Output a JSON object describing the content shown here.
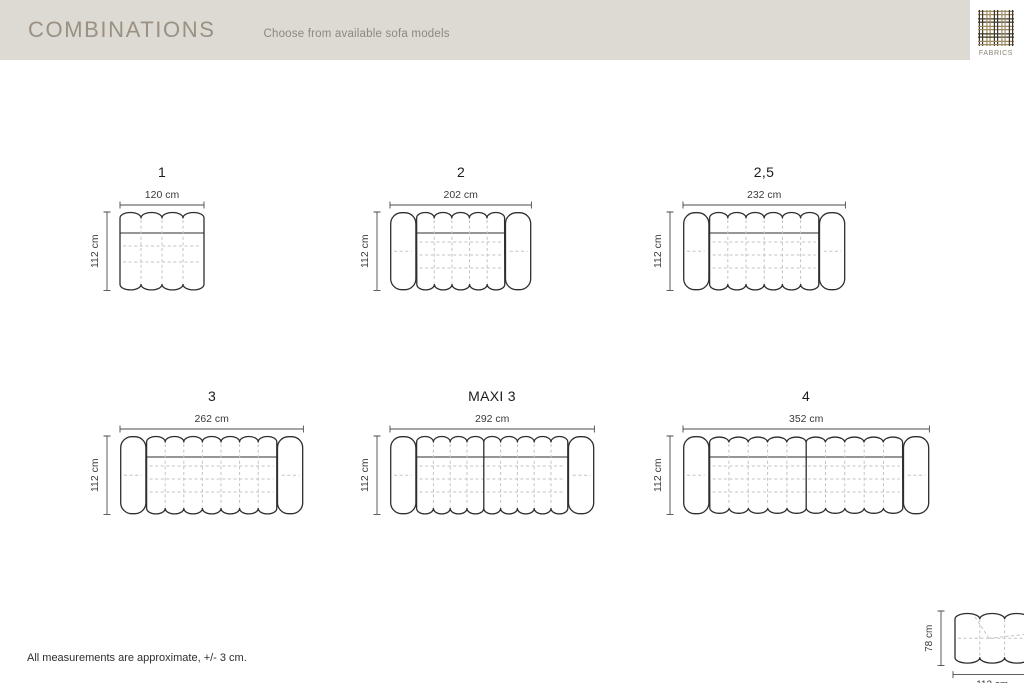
{
  "header": {
    "title": "COMBINATIONS",
    "subtitle": "Choose from available sofa models",
    "fabrics_label": "FABRICS"
  },
  "footer": {
    "note": "All measurements are approximate, +/- 3 cm."
  },
  "colors": {
    "header_bg": "#dcdad2",
    "title_text": "#9a9184",
    "subtitle_text": "#8c887f",
    "fabrics_text": "#8b8272",
    "outline": "#2e2e2e",
    "dashed": "#c3c3c3",
    "dimension": "#4a4a4a",
    "weave_dark": "#3f3526",
    "weave_tan": "#9c8a64"
  },
  "sofas": [
    {
      "label": "1",
      "width_label": "120 cm",
      "depth_label": "112 cm",
      "width_cm": 120,
      "depth_cm": 112,
      "arms": false,
      "modules": [
        4
      ]
    },
    {
      "label": "2",
      "width_label": "202 cm",
      "depth_label": "112 cm",
      "width_cm": 202,
      "depth_cm": 112,
      "arms": true,
      "modules": [
        5
      ]
    },
    {
      "label": "2,5",
      "width_label": "232 cm",
      "depth_label": "112 cm",
      "width_cm": 232,
      "depth_cm": 112,
      "arms": true,
      "modules": [
        6
      ]
    },
    {
      "label": "3",
      "width_label": "262 cm",
      "depth_label": "112 cm",
      "width_cm": 262,
      "depth_cm": 112,
      "arms": true,
      "modules": [
        7
      ]
    },
    {
      "label": "MAXI 3",
      "width_label": "292 cm",
      "depth_label": "112 cm",
      "width_cm": 292,
      "depth_cm": 112,
      "arms": true,
      "modules": [
        4,
        5
      ]
    },
    {
      "label": "4",
      "width_label": "352 cm",
      "depth_label": "112 cm",
      "width_cm": 352,
      "depth_cm": 112,
      "arms": true,
      "modules": [
        5,
        5
      ]
    }
  ],
  "ottoman": {
    "width_label": "112 cm",
    "depth_label": "78 cm",
    "seat_height_label": "46 cm",
    "width_cm": 112,
    "depth_cm": 78,
    "seat_height_cm": 46,
    "modules": [
      3
    ]
  }
}
